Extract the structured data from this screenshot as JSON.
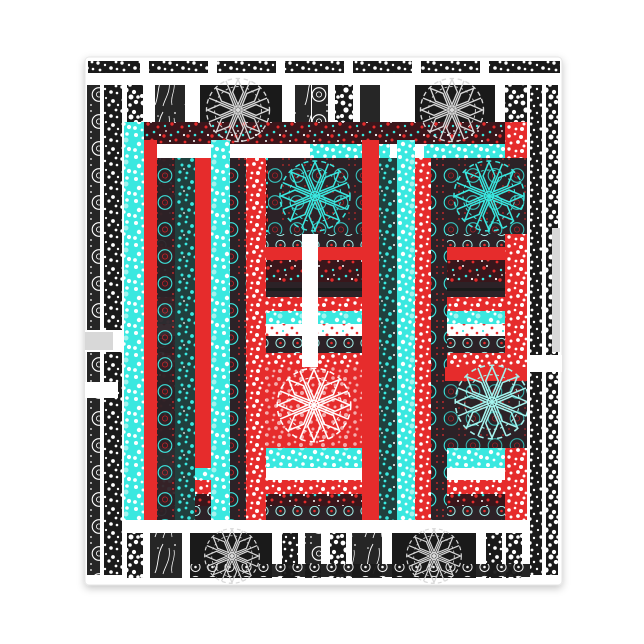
{
  "meta": {
    "kind": "product-image",
    "background": "#ffffff"
  },
  "product": {
    "type": "notepad",
    "description": "Square notepad product photo with an ornate black and white lace patchwork pattern, overlaid in the center by a red and aqua plaid patterned square with circular lace fan medallions",
    "text_visible": "none"
  },
  "colors": {
    "page_bg": "#ffffff",
    "white": "#ffffff",
    "ink_black": "#1a1a1a",
    "ink_dark": "#262626",
    "overlay_dark": "#2c2227",
    "maroon": "#3a161b",
    "red": "#e62c2c",
    "red_deep": "#c01f26",
    "cyan": "#3ae8e0",
    "cyan_light": "#a5f3ee",
    "teal_dark": "#20403e",
    "light_gray": "#d8d8d8",
    "pad_edge": "#e6e6e6"
  },
  "pattern": {
    "base": "black and white ornamental patchwork: speckled confetti bands, rosette dot columns, leaf sprig stripes, dark squares with lace fan medallions, segmented top border strip",
    "overlay": "red and aqua translucent plaid square with speckled stripes, rosette rows, white crossing bands and tinted lace fan medallions",
    "motif_names": [
      "speckle-band",
      "confetti-band",
      "rosette-column",
      "leaf-sprig-band",
      "dot-border-row",
      "lace-fan-medallion",
      "plaid-stripe"
    ]
  }
}
